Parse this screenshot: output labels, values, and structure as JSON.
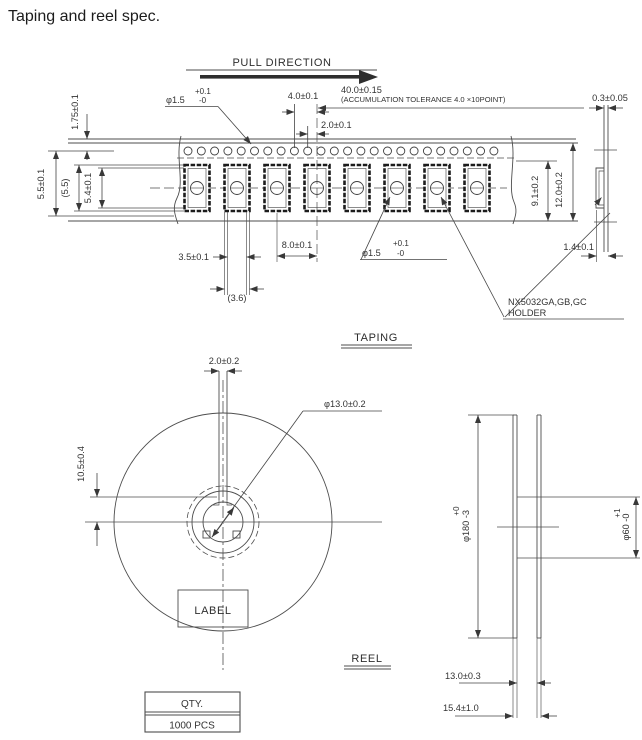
{
  "title": "Taping and reel spec.",
  "taping": {
    "section_label": "TAPING",
    "pull_direction": "PULL DIRECTION",
    "holder": {
      "line1": "NX5032GA,GB,GC",
      "line2": "HOLDER"
    },
    "dims": {
      "sprocket_hole": {
        "prefix": "φ1.5",
        "plus": "+0.1",
        "minus": "-0"
      },
      "sprocket_pitch": "4.0±0.1",
      "hole_to_pocket": "2.0±0.1",
      "accumulation": "40.0±0.15",
      "accumulation_note": "(ACCUMULATION TOLERANCE 4.0 ×10POINT)",
      "tape_thickness": "0.3±0.05",
      "edge_to_hole": "1.75±0.1",
      "hole_to_center": "5.5±0.1",
      "pocket_length_ref": "(5.5)",
      "pocket_length": "5.4±0.1",
      "pocket_width": "3.5±0.1",
      "pocket_width_ref": "(3.6)",
      "pocket_pitch": "8.0±0.1",
      "pocket_hole": {
        "prefix": "φ1.5",
        "plus": "+0.1",
        "minus": "-0"
      },
      "hole_edge_to_bottom": "9.1±0.2",
      "tape_width": "12.0±0.2",
      "pocket_depth": "1.4±0.1"
    }
  },
  "reel": {
    "section_label": "REEL",
    "label_box": "LABEL",
    "dims": {
      "slot_width": "2.0±0.2",
      "hub_hole": "φ13.0±0.2",
      "slot_depth": "10.5±0.4",
      "outer_dia": {
        "prefix": "φ180",
        "plus": "+0",
        "minus": "-3"
      },
      "hub_dia": {
        "prefix": "φ60",
        "plus": "+1",
        "minus": "-0"
      },
      "width_inner": "13.0±0.3",
      "width_outer": "15.4±1.0"
    }
  },
  "qty_table": {
    "header": "QTY.",
    "value": "1000 PCS"
  }
}
